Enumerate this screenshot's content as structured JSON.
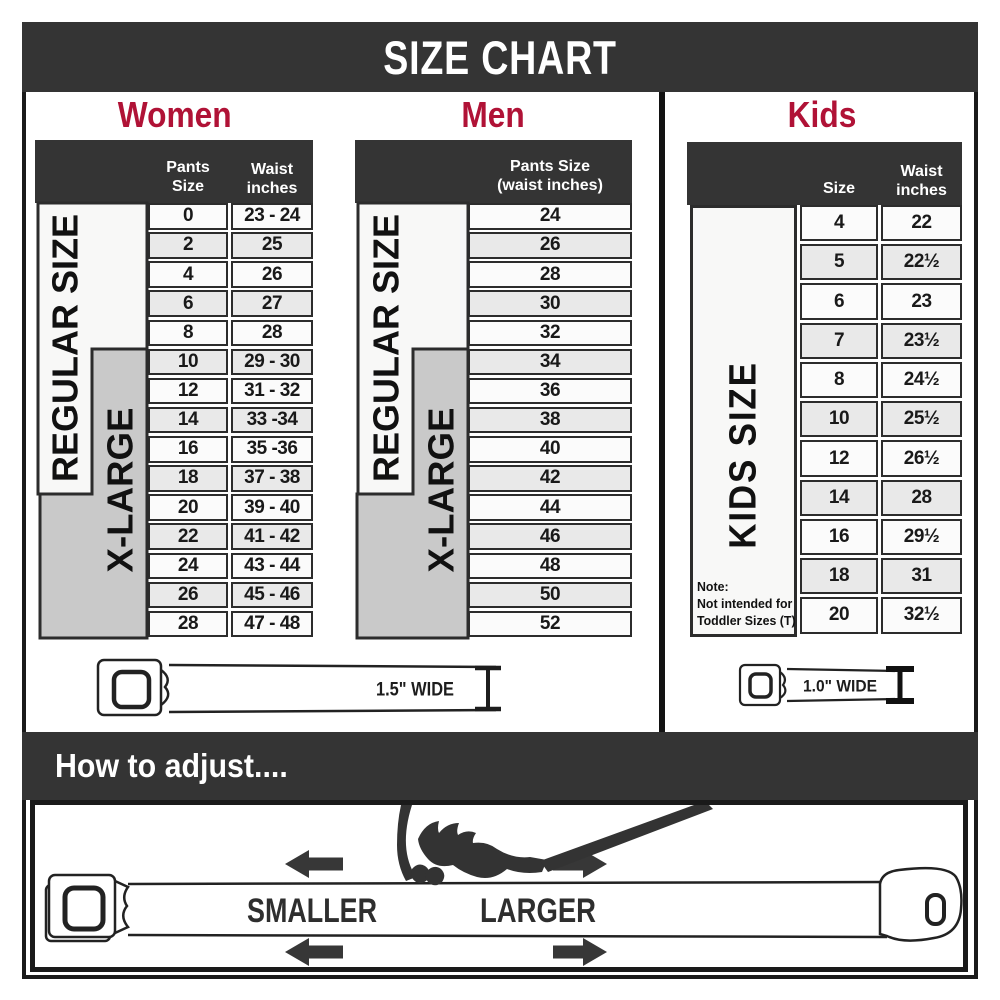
{
  "title": "SIZE CHART",
  "colors": {
    "accent_red": "#b01236",
    "band_dark": "#343434",
    "gray_box": "#c9c9c9",
    "row_alt": "#e9e9e9"
  },
  "sections": {
    "women": {
      "heading": "Women",
      "col1_header": "Pants Size",
      "col2_header_line1": "Waist",
      "col2_header_line2": "inches",
      "regular_label": "REGULAR SIZE",
      "xlarge_label": "X-LARGE",
      "rows": [
        {
          "size": "0",
          "waist": "23 - 24"
        },
        {
          "size": "2",
          "waist": "25"
        },
        {
          "size": "4",
          "waist": "26"
        },
        {
          "size": "6",
          "waist": "27"
        },
        {
          "size": "8",
          "waist": "28"
        },
        {
          "size": "10",
          "waist": "29 - 30"
        },
        {
          "size": "12",
          "waist": "31 - 32"
        },
        {
          "size": "14",
          "waist": "33 -34"
        },
        {
          "size": "16",
          "waist": "35 -36"
        },
        {
          "size": "18",
          "waist": "37 - 38"
        },
        {
          "size": "20",
          "waist": "39 - 40"
        },
        {
          "size": "22",
          "waist": "41 - 42"
        },
        {
          "size": "24",
          "waist": "43 - 44"
        },
        {
          "size": "26",
          "waist": "45 - 46"
        },
        {
          "size": "28",
          "waist": "47 - 48"
        }
      ]
    },
    "men": {
      "heading": "Men",
      "col_header_line1": "Pants Size",
      "col_header_line2": "(waist inches)",
      "regular_label": "REGULAR SIZE",
      "xlarge_label": "X-LARGE",
      "rows": [
        "24",
        "26",
        "28",
        "30",
        "32",
        "34",
        "36",
        "38",
        "40",
        "42",
        "44",
        "46",
        "48",
        "50",
        "52"
      ]
    },
    "kids": {
      "heading": "Kids",
      "col1_header": "Size",
      "col2_header_line1": "Waist",
      "col2_header_line2": "inches",
      "side_label": "KIDS SIZE",
      "note_line1": "Note:",
      "note_line2": "Not intended for",
      "note_line3": "Toddler Sizes (T)",
      "rows": [
        {
          "size": "4",
          "waist": "22"
        },
        {
          "size": "5",
          "waist": "22½"
        },
        {
          "size": "6",
          "waist": "23"
        },
        {
          "size": "7",
          "waist": "23½"
        },
        {
          "size": "8",
          "waist": "24½"
        },
        {
          "size": "10",
          "waist": "25½"
        },
        {
          "size": "12",
          "waist": "26½"
        },
        {
          "size": "14",
          "waist": "28"
        },
        {
          "size": "16",
          "waist": "29½"
        },
        {
          "size": "18",
          "waist": "31"
        },
        {
          "size": "20",
          "waist": "32½"
        }
      ]
    }
  },
  "belts": {
    "adult_width_label": "1.5\" WIDE",
    "kids_width_label": "1.0\" WIDE"
  },
  "adjust": {
    "heading": "How to adjust....",
    "smaller_label": "SMALLER",
    "larger_label": "LARGER"
  }
}
